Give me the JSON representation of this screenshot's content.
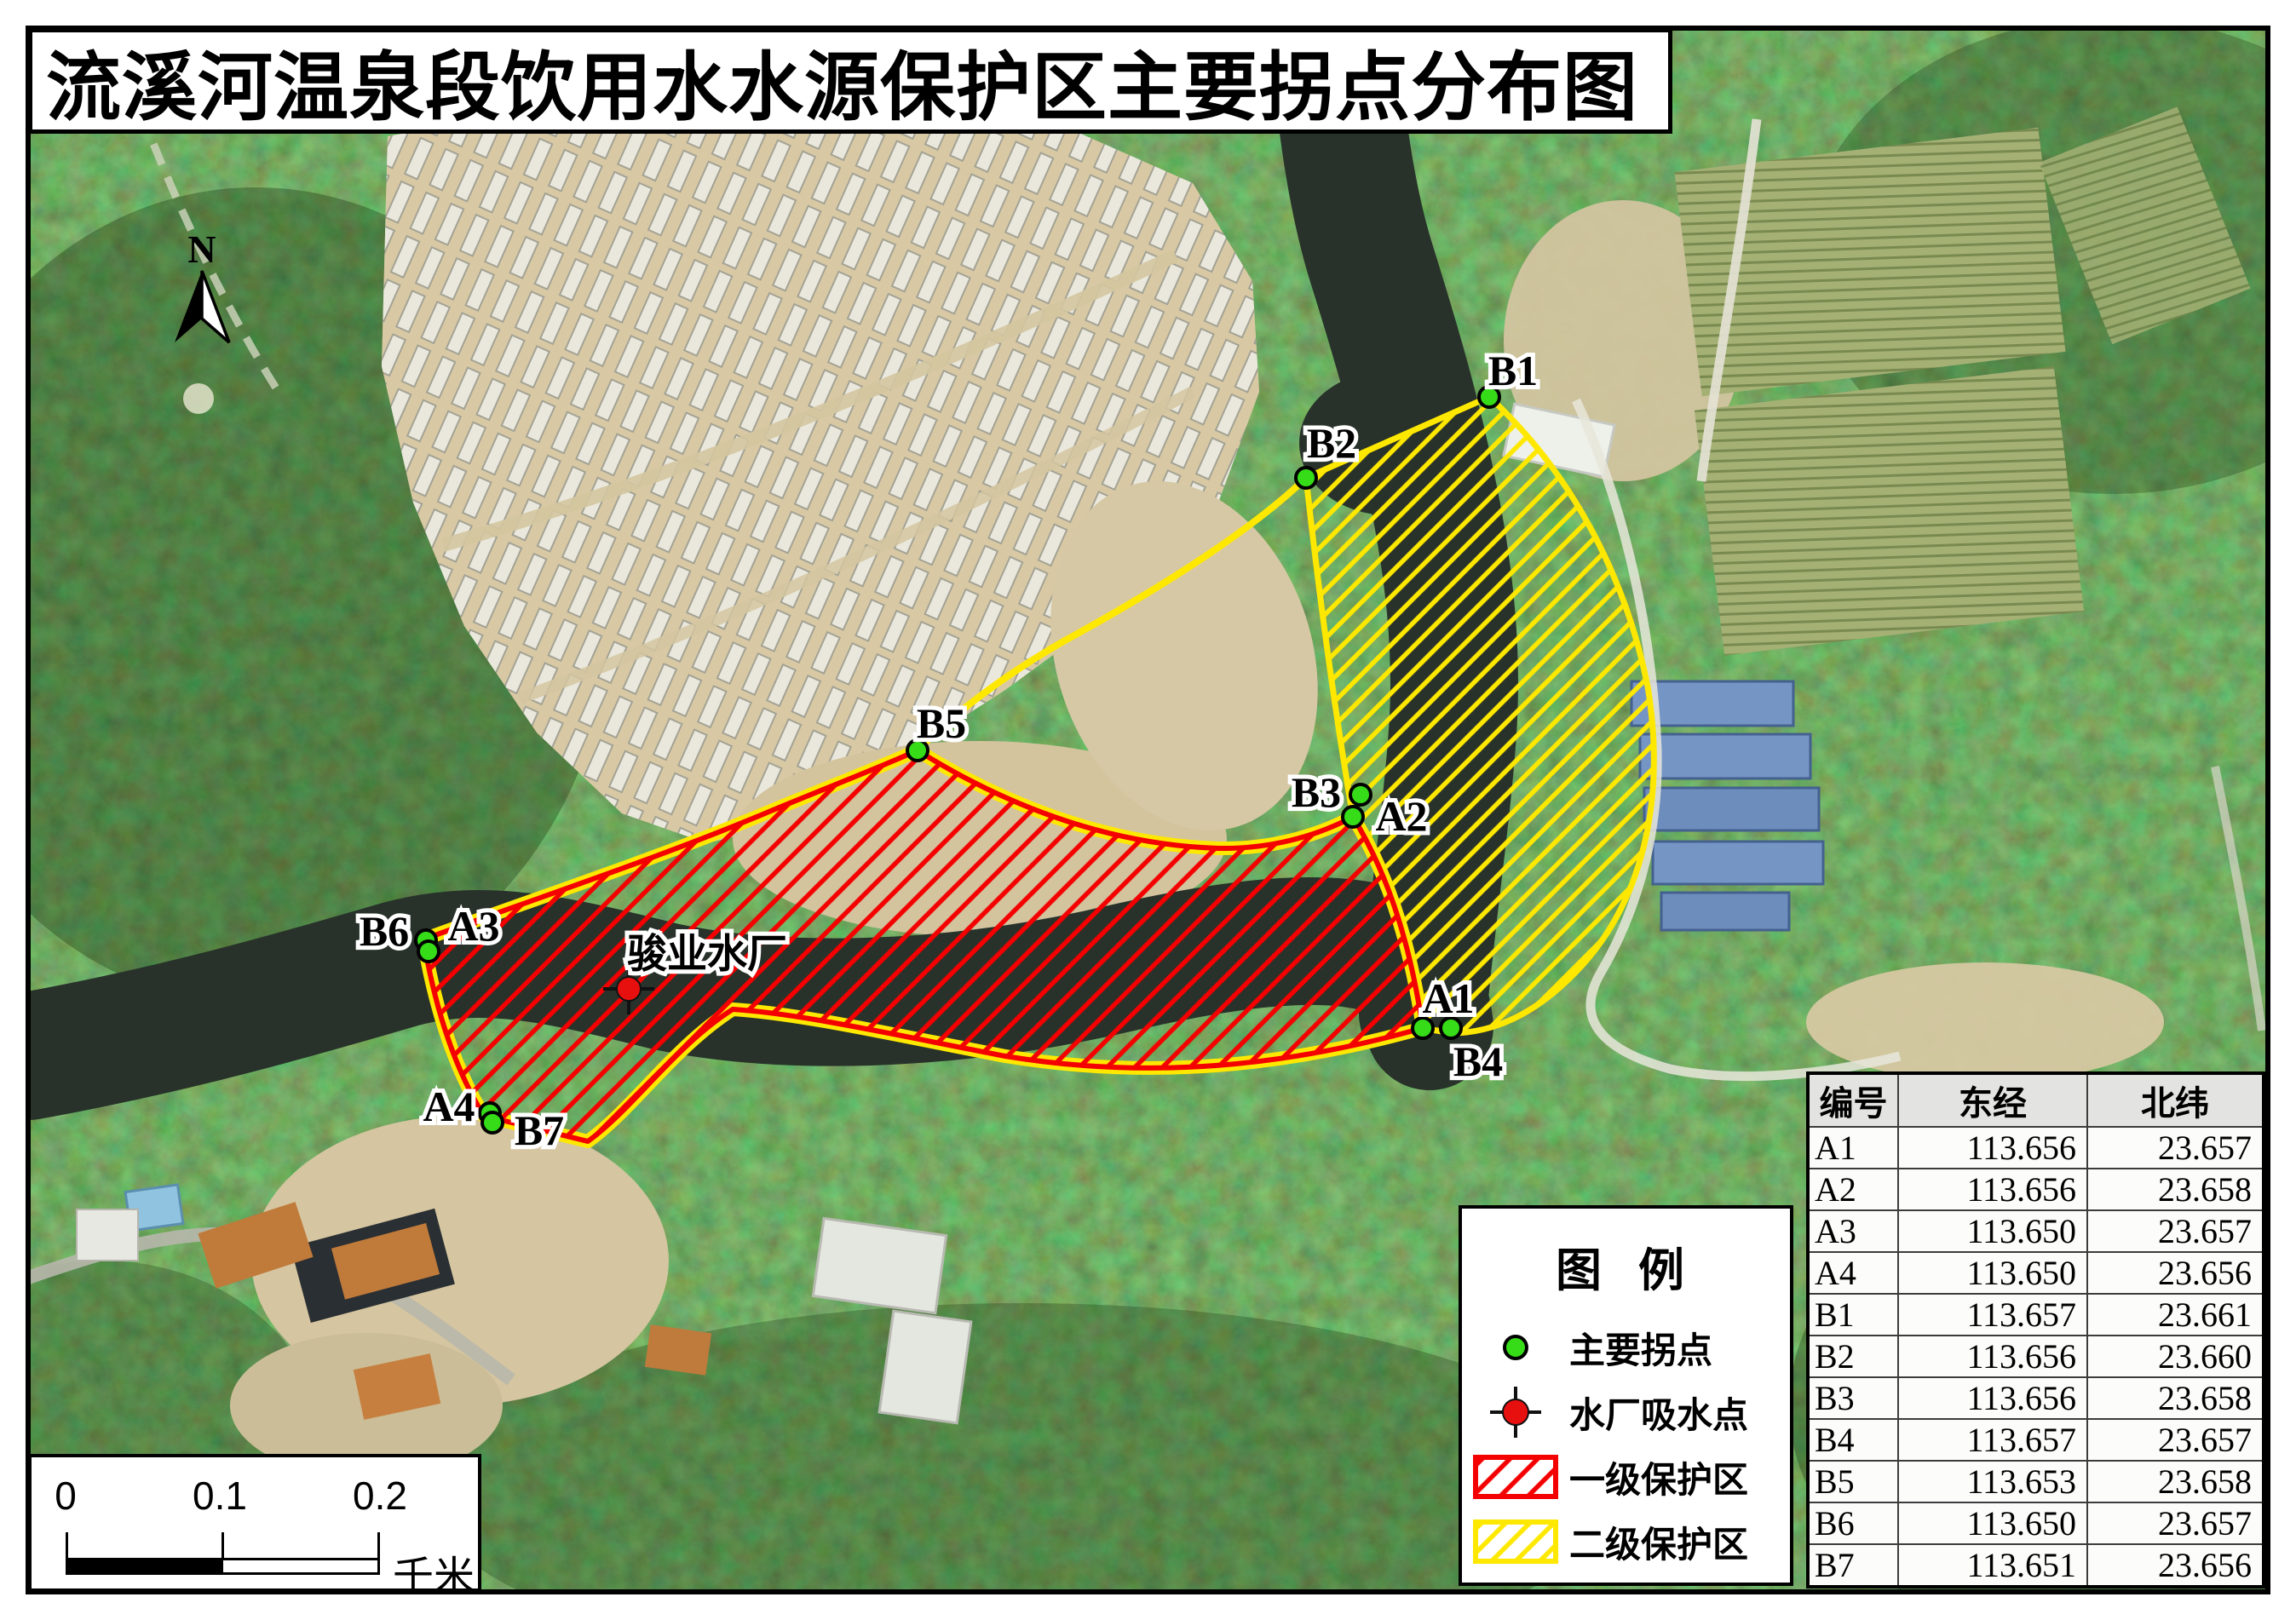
{
  "title": "流溪河温泉段饮用水水源保护区主要拐点分布图",
  "north_arrow": {
    "label": "N"
  },
  "water_plant_label": "骏业水厂",
  "points": {
    "a1": "A1",
    "a2": "A2",
    "a3": "A3",
    "a4": "A4",
    "b1": "B1",
    "b2": "B2",
    "b3": "B3",
    "b4": "B4",
    "b5": "B5",
    "b6": "B6",
    "b7": "B7"
  },
  "legend": {
    "title": "图 例",
    "items": [
      {
        "symbol": "green-point",
        "label": "主要拐点"
      },
      {
        "symbol": "red-intake-point",
        "label": "水厂吸水点"
      },
      {
        "symbol": "red-hatch-swatch",
        "label": "一级保护区"
      },
      {
        "symbol": "yellow-hatch-swatch",
        "label": "二级保护区"
      }
    ]
  },
  "scalebar": {
    "ticks": [
      "0",
      "0.1",
      "0.2"
    ],
    "unit": "千米"
  },
  "table": {
    "headers": [
      "编号",
      "东经",
      "北纬"
    ],
    "rows": [
      [
        "A1",
        "113.656",
        "23.657"
      ],
      [
        "A2",
        "113.656",
        "23.658"
      ],
      [
        "A3",
        "113.650",
        "23.657"
      ],
      [
        "A4",
        "113.650",
        "23.656"
      ],
      [
        "B1",
        "113.657",
        "23.661"
      ],
      [
        "B2",
        "113.656",
        "23.660"
      ],
      [
        "B3",
        "113.656",
        "23.658"
      ],
      [
        "B4",
        "113.657",
        "23.657"
      ],
      [
        "B5",
        "113.653",
        "23.658"
      ],
      [
        "B6",
        "113.650",
        "23.657"
      ],
      [
        "B7",
        "113.651",
        "23.656"
      ]
    ]
  },
  "colors": {
    "primary_zone_red": "#f40000",
    "secondary_zone_yellow": "#ffe800",
    "turn_point_green": "#35dc17",
    "intake_red": "#e80f0f"
  }
}
